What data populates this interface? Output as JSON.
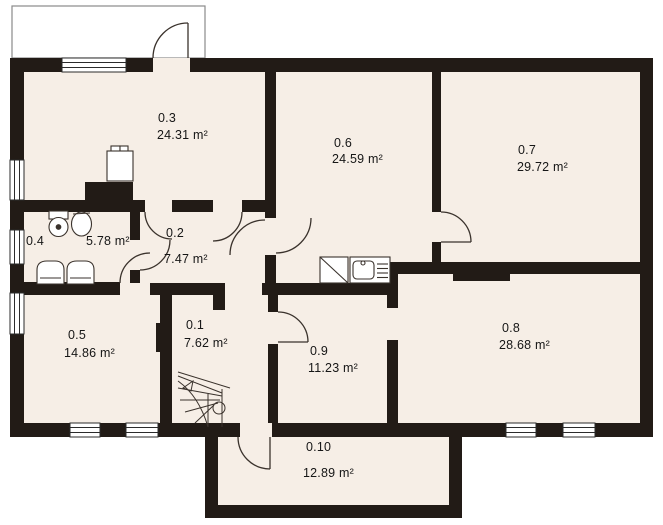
{
  "plan": {
    "title": "floor-plan",
    "unit": "m²",
    "colors": {
      "background": "#ffffff",
      "floor": "#f6eee6",
      "wall": "#221b16",
      "line": "#3a322c"
    },
    "rooms": [
      {
        "id": "0.1",
        "area_label": "7.62 m²",
        "num_pos": [
          186,
          318
        ],
        "area_pos": [
          184,
          336
        ]
      },
      {
        "id": "0.2",
        "area_label": "7.47 m²",
        "num_pos": [
          166,
          226
        ],
        "area_pos": [
          164,
          252
        ]
      },
      {
        "id": "0.3",
        "area_label": "24.31 m²",
        "num_pos": [
          158,
          111
        ],
        "area_pos": [
          157,
          128
        ]
      },
      {
        "id": "0.4",
        "area_label": "5.78 m²",
        "num_pos": [
          26,
          234
        ],
        "area_pos": [
          86,
          234
        ]
      },
      {
        "id": "0.5",
        "area_label": "14.86 m²",
        "num_pos": [
          68,
          328
        ],
        "area_pos": [
          64,
          346
        ]
      },
      {
        "id": "0.6",
        "area_label": "24.59 m²",
        "num_pos": [
          334,
          136
        ],
        "area_pos": [
          332,
          152
        ]
      },
      {
        "id": "0.7",
        "area_label": "29.72 m²",
        "num_pos": [
          518,
          143
        ],
        "area_pos": [
          517,
          160
        ]
      },
      {
        "id": "0.8",
        "area_label": "28.68 m²",
        "num_pos": [
          502,
          321
        ],
        "area_pos": [
          499,
          338
        ]
      },
      {
        "id": "0.9",
        "area_label": "11.23 m²",
        "num_pos": [
          310,
          344
        ],
        "area_pos": [
          308,
          361
        ]
      },
      {
        "id": "0.10",
        "area_label": "12.89 m²",
        "num_pos": [
          306,
          440
        ],
        "area_pos": [
          303,
          466
        ]
      }
    ]
  }
}
